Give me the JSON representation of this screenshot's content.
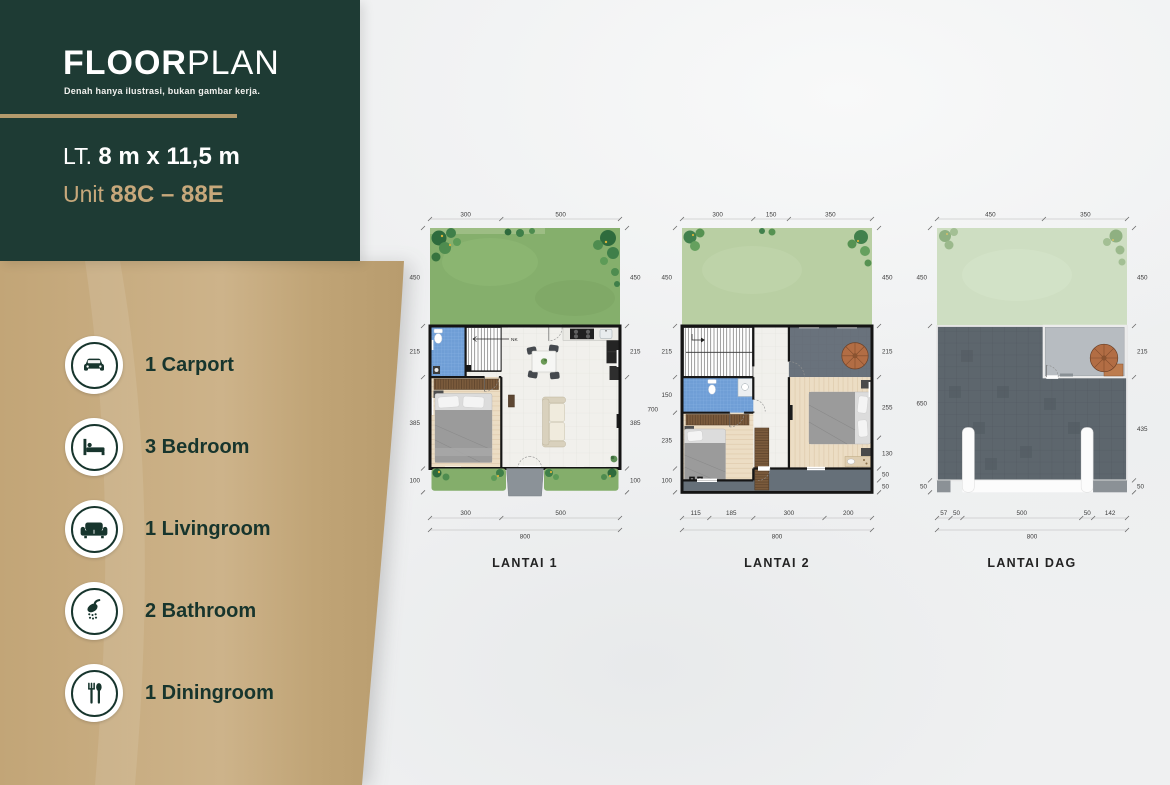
{
  "header": {
    "title_bold": "FLOOR",
    "title_light": "PLAN",
    "subtitle": "Denah hanya ilustrasi, bukan gambar kerja.",
    "land_label": "LT.",
    "land_size": "8 m x 11,5 m",
    "unit_label": "Unit",
    "unit_value": "88C – 88E"
  },
  "legend": {
    "items": [
      {
        "icon": "car-icon",
        "label": "1 Carport"
      },
      {
        "icon": "bed-icon",
        "label": "3 Bedroom"
      },
      {
        "icon": "sofa-icon",
        "label": "1 Livingroom"
      },
      {
        "icon": "shower-icon",
        "label": "2 Bathroom"
      },
      {
        "icon": "cutlery-icon",
        "label": "1 Diningroom"
      }
    ]
  },
  "plans": [
    {
      "name": "LANTAI 1",
      "stair_label": "NK",
      "dims_top": [
        "300",
        "500"
      ],
      "dims_left": [
        "450",
        "215",
        "385",
        "100"
      ],
      "dims_right": [
        "450",
        "215",
        "385",
        "100"
      ],
      "dims_bottom": [
        "300",
        "500"
      ],
      "dim_total": "800"
    },
    {
      "name": "LANTAI 2",
      "stair_label": "TR",
      "dim_left_outer": "700",
      "dims_top": [
        "300",
        "150",
        "350"
      ],
      "dims_left": [
        "450",
        "215",
        "150",
        "235",
        "100"
      ],
      "dims_right": [
        "450",
        "215",
        "255",
        "130",
        "50",
        "50"
      ],
      "dims_bottom": [
        "115",
        "185",
        "300",
        "200"
      ],
      "dim_total": "800"
    },
    {
      "name": "LANTAI DAG",
      "dims_top": [
        "450",
        "350"
      ],
      "dims_left": [
        "450",
        "650",
        "50"
      ],
      "dims_right": [
        "450",
        "215",
        "435",
        "50"
      ],
      "dims_bottom": [
        "57",
        "50",
        "500",
        "50",
        "142"
      ],
      "dim_total": "800"
    }
  ],
  "colors": {
    "brand_green": "#1e3b34",
    "accent_tan": "#c3a77c",
    "grass_l1": "#85af6c",
    "grass_l2": "#b9cfa3",
    "grass_dag": "#cedec2",
    "roof_deck_gray": "#5d666d",
    "bath_tile_blue": "#6f9ed6",
    "wood_floor": "#ecddc4"
  }
}
